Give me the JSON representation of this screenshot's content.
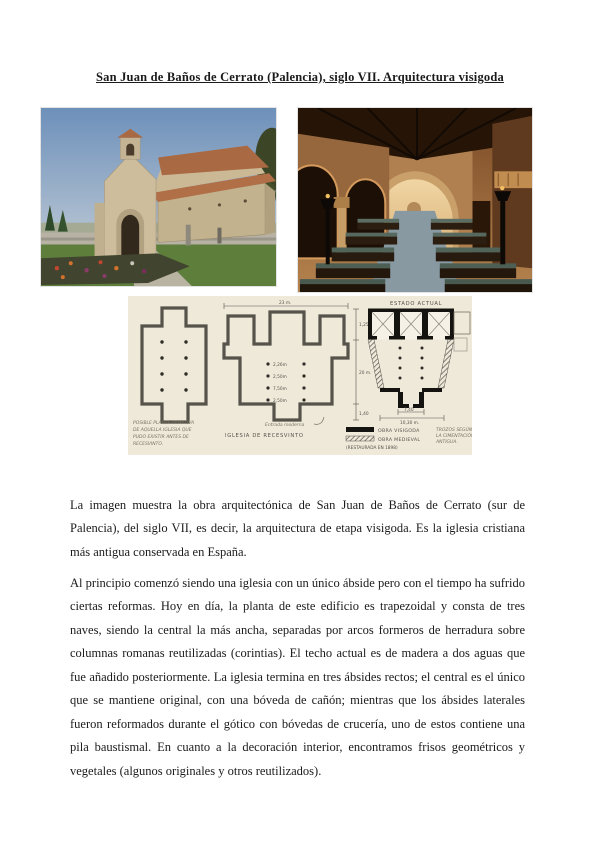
{
  "document": {
    "title": "San Juan de Baños de Cerrato (Palencia), siglo VII. Arquitectura visigoda",
    "paragraphs": [
      "La imagen muestra la obra arquitectónica de San Juan de Baños de Cerrato (sur de Palencia), del siglo VII, es decir, la arquitectura de etapa visigoda. Es la iglesia cristiana más antigua conservada en España.",
      "Al principio comenzó siendo una iglesia con un único ábside pero con el tiempo ha sufrido ciertas reformas. Hoy en día, la planta de este edificio es trapezoidal y consta de tres naves, siendo la central la más ancha, separadas por arcos formeros de herradura sobre columnas romanas reutilizadas (corintias). El techo actual es de madera a dos aguas que fue añadido posteriormente. La iglesia termina en tres ábsides rectos; el central es el único que se mantiene original, con una bóveda de cañón; mientras que los ábsides laterales fueron reformados durante el gótico con bóvedas de crucería, uno de estos contiene una pila baustismal. En cuanto a la decoración interior, encontramos frisos geométricos y vegetales (algunos originales y otros reutilizados)."
    ]
  },
  "plan": {
    "estado_actual_title": "ESTADO ACTUAL",
    "recesvinto_caption": "IGLESIA DE RECESVINTO",
    "primitive_caption_lines": [
      "POSIBLE PLANTA PRIMITIVA",
      "DE AQUELLA IGLESIA QUE",
      "PUDO EXISTIR ANTES DE",
      "RECESVINTO."
    ],
    "entrance_note": "Entrada moderna",
    "dimensions": {
      "top_width": "23 m.",
      "side_length": "20 m.",
      "chapel_depth": "1,25",
      "portico_depth": "1,40",
      "aisle_1": "2,26m",
      "aisle_2": "2,50m",
      "aisle_3": "7,50m",
      "aisle_4": "2,50m",
      "portico_width": "7,40",
      "west_width": "10,30 m."
    },
    "legend": {
      "visigoda_label": "OBRA VISIGODA",
      "medieval_label": "OBRA MEDIEVAL",
      "restored_note": "(RESTAURADA EN 1898)",
      "side_note_lines": [
        "TROZOS SEGÚN",
        "LA CIMENTACIÓN",
        "ANTIGUA."
      ]
    }
  },
  "colors": {
    "page_background": "#ffffff",
    "body_text": "#1b1b1b",
    "plan_paper": "#efe9da",
    "plan_ink": "#56534a"
  }
}
